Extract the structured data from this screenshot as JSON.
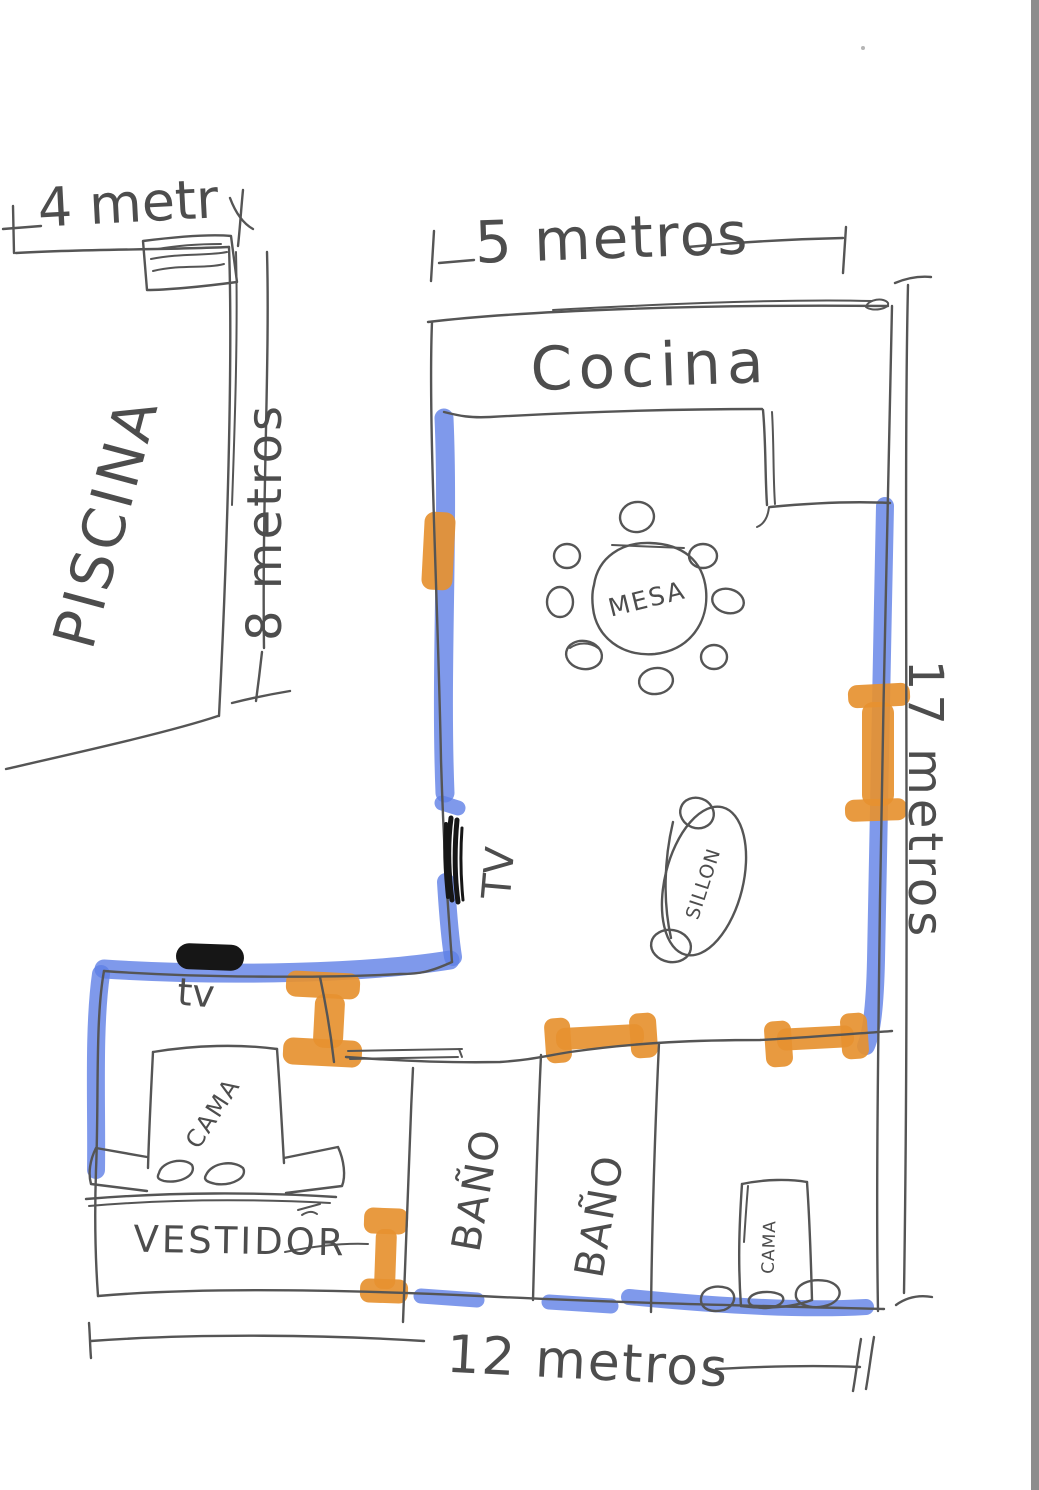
{
  "sketch_type": "hand-drawn floor plan",
  "labels": {
    "pool": "PISCINA",
    "kitchen": "Cocina",
    "table": "MESA",
    "sofa": "SILLON",
    "tv_living": "TV",
    "tv_bedroom": "tv",
    "bed_left": "CAMA",
    "bed_right": "CAMA",
    "dressing_room": "VESTIDOR",
    "bathroom_1": "BAÑO",
    "bathroom_2": "BAÑO"
  },
  "dimensions": {
    "pool_width": "4 metr",
    "pool_height": "8 metros",
    "kitchen_width": "5 metros",
    "house_width": "12 metros",
    "house_height": "17 metros"
  },
  "colors": {
    "pen": "#555555",
    "text": "#4D4D4D",
    "wall_blue": "#5F80E6",
    "door_orange": "#E69130",
    "tv_black": "#161616",
    "bg": "#FFFFFF",
    "edge_grey": "#8D8D8D"
  }
}
